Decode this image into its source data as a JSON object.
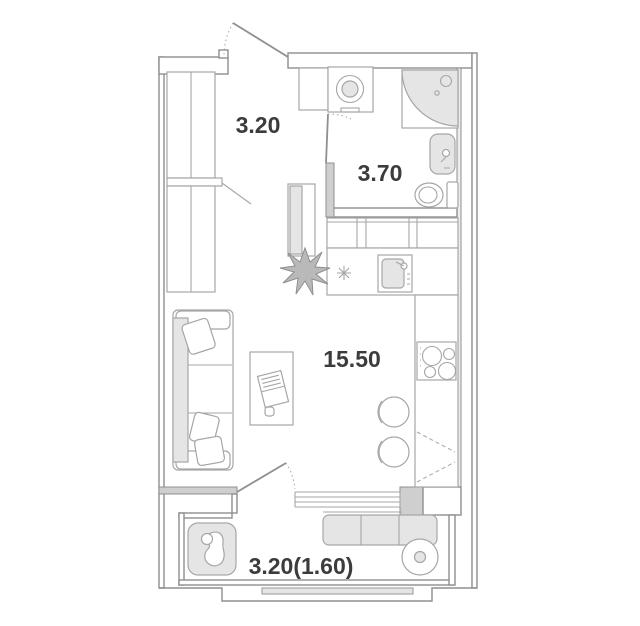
{
  "colors": {
    "bg": "#ffffff",
    "line": "#8f8f8f",
    "line_light": "#a6a6a6",
    "gray_fill": "#e5e5e5",
    "dark_fill": "#cfcfcf",
    "label": "#3c3c3c"
  },
  "rooms": {
    "hallway": {
      "name": "hallway",
      "area": "3.20"
    },
    "bathroom": {
      "name": "bathroom",
      "area": "3.70"
    },
    "living": {
      "name": "living-kitchen room",
      "area": "15.50"
    },
    "balcony": {
      "name": "balcony",
      "area": "3.20(1.60)"
    }
  },
  "fixtures": [
    "entrance-door",
    "wardrobe-upper",
    "wardrobe-lower",
    "wardrobe-shelf",
    "bathroom-cabinet",
    "washing-machine",
    "corner-shower",
    "washbasin",
    "toilet",
    "bathroom-door",
    "refrigerator",
    "kitchen-wall-cabinets",
    "kitchen-counter",
    "kitchen-sink",
    "cooktop",
    "tall-kitchen-unit",
    "bar-stool",
    "bar-stool",
    "houseplant",
    "small-plant",
    "sofa",
    "pillow",
    "desk",
    "laptop",
    "mouse",
    "balcony-door",
    "balcony-window",
    "facade-window",
    "lounge-chair",
    "balcony-bench",
    "balcony-table"
  ]
}
